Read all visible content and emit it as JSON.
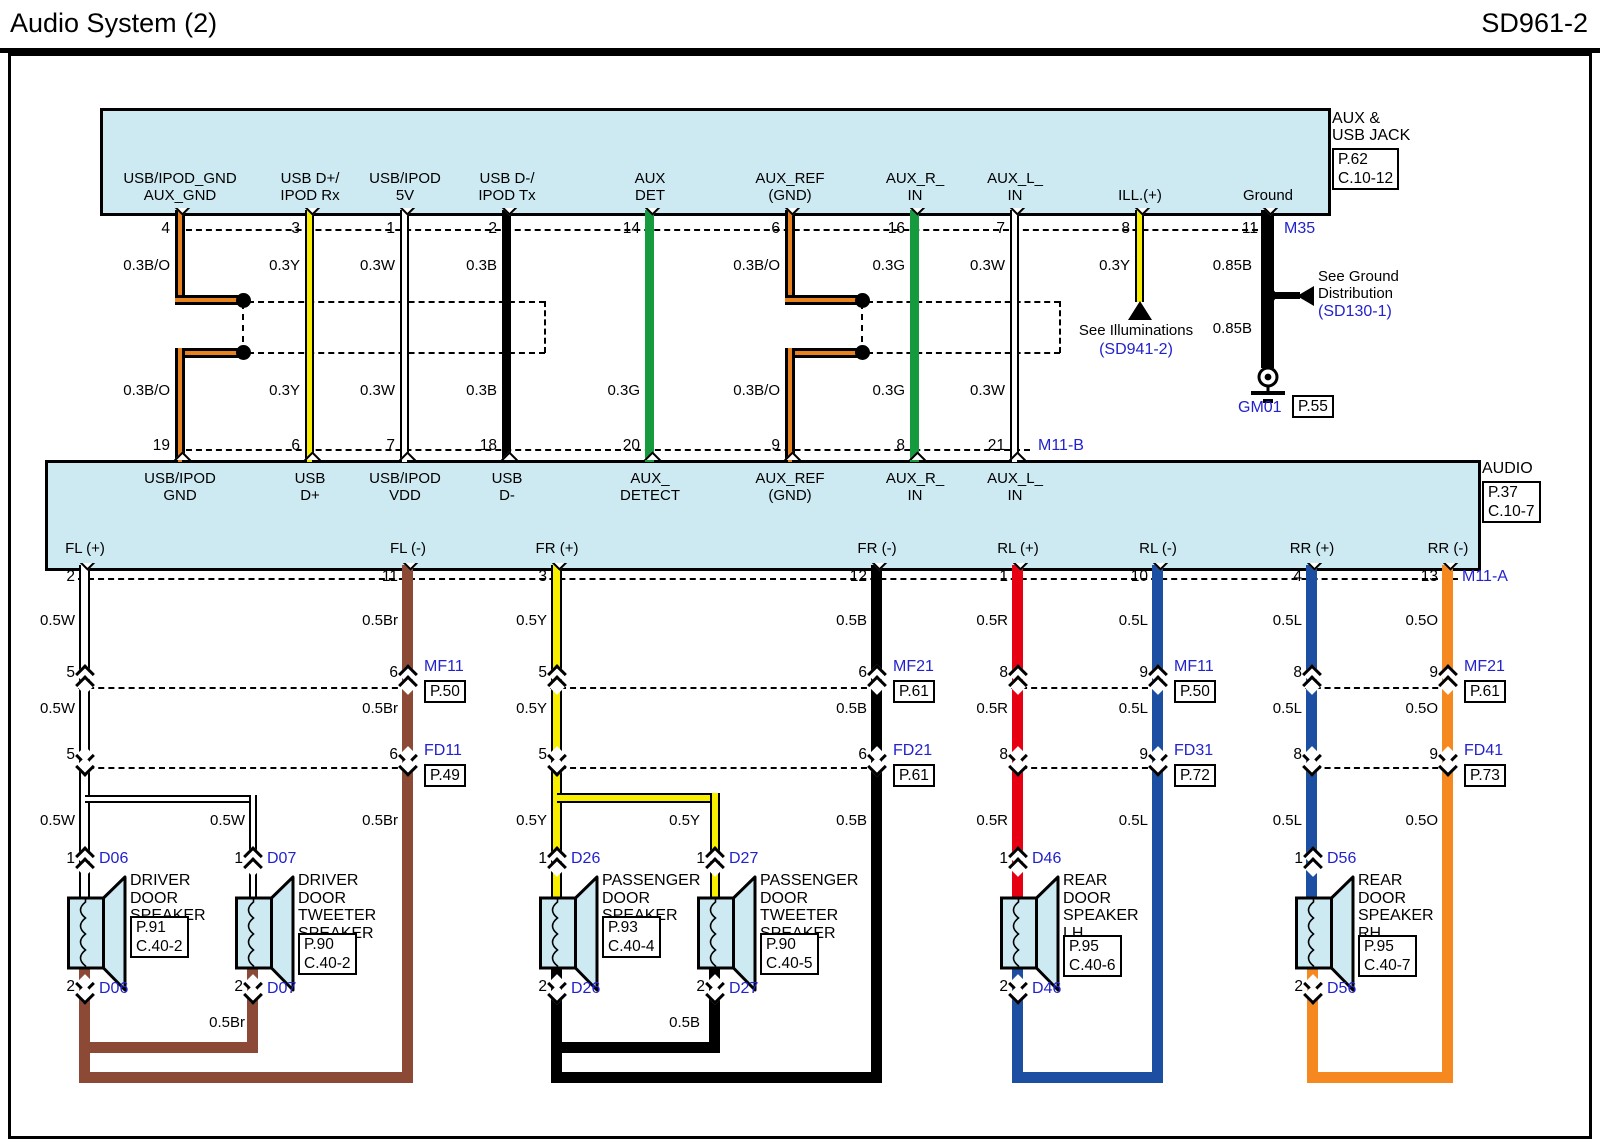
{
  "header": {
    "title": "Audio System (2)",
    "code": "SD961-2"
  },
  "palette": {
    "component_fill": "#cde9f2",
    "wire_yellow": "#f8ee00",
    "wire_green": "#169a3e",
    "wire_white": "#ffffff",
    "wire_black": "#000000",
    "wire_brown": "#8c4a36",
    "wire_red": "#e60012",
    "wire_blue": "#1c4fa1",
    "wire_orange": "#f5891f",
    "wire_stripe_orange": "#e8821e",
    "ref_text_blue": "#2222cc"
  },
  "aux_jack": {
    "name": "AUX &\nUSB JACK",
    "ref": "P.62\nC.10-12",
    "connector_top": "M35",
    "connector_bottom": "M11-B",
    "pins": [
      {
        "label": "USB/IPOD_GND\nAUX_GND",
        "pin": "4",
        "color_upper": "0.3B/O",
        "color_lower": "0.3B/O",
        "pin2": "19"
      },
      {
        "label": "USB D+/\nIPOD Rx",
        "pin": "3",
        "color_upper": "0.3Y",
        "color_lower": "0.3Y",
        "pin2": "6"
      },
      {
        "label": "USB/IPOD\n5V",
        "pin": "1",
        "color_upper": "0.3W",
        "color_lower": "0.3W",
        "pin2": "7"
      },
      {
        "label": "USB D-/\nIPOD Tx",
        "pin": "2",
        "color_upper": "0.3B",
        "color_lower": "0.3B",
        "pin2": "18"
      },
      {
        "label": "AUX\nDET",
        "pin": "14",
        "color_upper": "",
        "color_lower": "0.3G",
        "pin2": "20"
      },
      {
        "label": "AUX_REF\n(GND)",
        "pin": "6",
        "color_upper": "0.3B/O",
        "color_lower": "0.3B/O",
        "pin2": "9"
      },
      {
        "label": "AUX_R_\nIN",
        "pin": "16",
        "color_upper": "0.3G",
        "color_lower": "0.3G",
        "pin2": "8"
      },
      {
        "label": "AUX_L_\nIN",
        "pin": "7",
        "color_upper": "0.3W",
        "color_lower": "0.3W",
        "pin2": "21"
      },
      {
        "label": "ILL.(+)",
        "pin": "8",
        "color_upper": "0.3Y",
        "color_lower": "",
        "pin2": ""
      },
      {
        "label": "Ground",
        "pin": "11",
        "color_upper": "0.85B",
        "color_lower": "0.85B",
        "pin2": ""
      }
    ]
  },
  "illumination": {
    "note": "See Illuminations",
    "ref": "(SD941-2)"
  },
  "ground": {
    "note": "See Ground\nDistribution",
    "ref": "(SD130-1)",
    "id": "GM01",
    "page": "P.55"
  },
  "audio": {
    "name": "AUDIO",
    "ref": "P.37\nC.10-7",
    "connector": "M11-A",
    "top_pins": [
      "USB/IPOD\nGND",
      "USB\nD+",
      "USB/IPOD\nVDD",
      "USB\nD-",
      "AUX_\nDETECT",
      "AUX_REF\n(GND)",
      "AUX_R_\nIN",
      "AUX_L_\nIN"
    ],
    "channels": [
      {
        "label": "FL (+)",
        "pin": "2",
        "color": "0.5W",
        "mf_pin": "5",
        "fd_pin": "5"
      },
      {
        "label": "FL (-)",
        "pin": "11",
        "color": "0.5Br",
        "mf_pin": "6",
        "fd_pin": "6"
      },
      {
        "label": "FR (+)",
        "pin": "3",
        "color": "0.5Y",
        "mf_pin": "5",
        "fd_pin": "5"
      },
      {
        "label": "FR (-)",
        "pin": "12",
        "color": "0.5B",
        "mf_pin": "6",
        "fd_pin": "6"
      },
      {
        "label": "RL (+)",
        "pin": "1",
        "color": "0.5R",
        "mf_pin": "8",
        "fd_pin": "8"
      },
      {
        "label": "RL (-)",
        "pin": "10",
        "color": "0.5L",
        "mf_pin": "9",
        "fd_pin": "9"
      },
      {
        "label": "RR (+)",
        "pin": "4",
        "color": "0.5L",
        "mf_pin": "8",
        "fd_pin": "8"
      },
      {
        "label": "RR (-)",
        "pin": "13",
        "color": "0.5O",
        "mf_pin": "9",
        "fd_pin": "9"
      }
    ]
  },
  "inline_connectors": {
    "mf": [
      {
        "name": "MF11",
        "page": "P.50"
      },
      {
        "name": "MF21",
        "page": "P.61"
      },
      {
        "name": "MF11",
        "page": "P.50"
      },
      {
        "name": "MF21",
        "page": "P.61"
      }
    ],
    "fd": [
      {
        "name": "FD11",
        "page": "P.49"
      },
      {
        "name": "FD21",
        "page": "P.61"
      },
      {
        "name": "FD31",
        "page": "P.72"
      },
      {
        "name": "FD41",
        "page": "P.73"
      }
    ]
  },
  "speakers": [
    {
      "id": "D06",
      "name": "DRIVER\nDOOR\nSPEAKER",
      "ref": "P.91\nC.40-2",
      "pin_in": "1",
      "pin_out": "2"
    },
    {
      "id": "D07",
      "name": "DRIVER\nDOOR\nTWEETER\nSPEAKER",
      "ref": "P.90\nC.40-2",
      "pin_in": "1",
      "pin_out": "2",
      "branch_color": "0.5W"
    },
    {
      "id": "D26",
      "name": "PASSENGER\nDOOR\nSPEAKER",
      "ref": "P.93\nC.40-4",
      "pin_in": "1",
      "pin_out": "2"
    },
    {
      "id": "D27",
      "name": "PASSENGER\nDOOR\nTWEETER\nSPEAKER",
      "ref": "P.90\nC.40-5",
      "pin_in": "1",
      "pin_out": "2",
      "branch_color": "0.5Y"
    },
    {
      "id": "D46",
      "name": "REAR\nDOOR\nSPEAKER\nLH",
      "ref": "P.95\nC.40-6",
      "pin_in": "1",
      "pin_out": "2"
    },
    {
      "id": "D56",
      "name": "REAR\nDOOR\nSPEAKER\nRH",
      "ref": "P.95\nC.40-7",
      "pin_in": "1",
      "pin_out": "2"
    }
  ],
  "returns": {
    "front_left": "0.5Br",
    "front_right": "0.5B"
  }
}
